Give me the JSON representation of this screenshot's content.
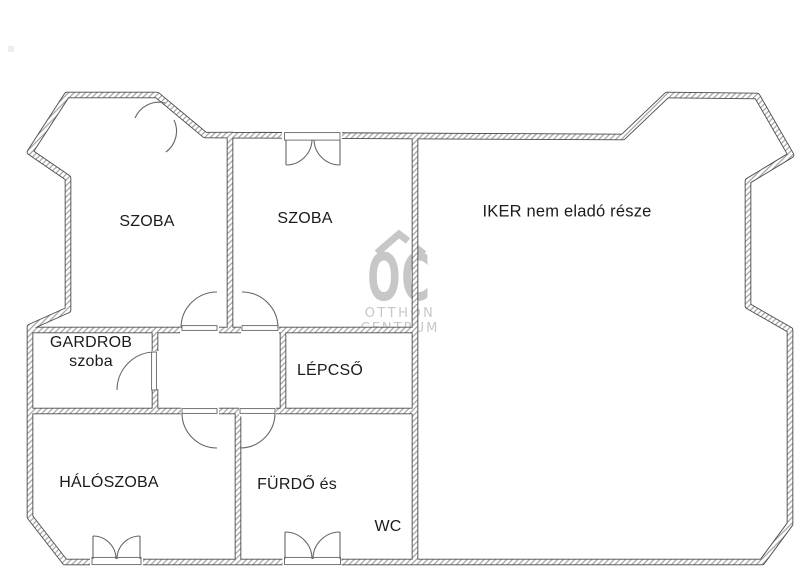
{
  "page": {
    "type": "apartment-floor-plan"
  },
  "rooms": {
    "szoba_left": "SZOBA",
    "szoba_middle": "SZOBA",
    "iker": "IKER nem eladó része",
    "gardrob_line1": "GARDROB",
    "gardrob_line2": "szoba",
    "lepcso": "LÉPCSŐ",
    "haloszoba": "HÁLÓSZOBA",
    "furdo": "FÜRDŐ és",
    "wc": "WC"
  },
  "watermark": {
    "logo_text": "OC",
    "line1": "OTTHON",
    "line2": "CENTRUM",
    "color": "#c7c7c7"
  },
  "colors": {
    "background": "#ffffff",
    "wall_line": "#4a4a4a",
    "wall_hatch": "#a0a0a0",
    "door_arc": "#666666",
    "label_text": "#1b1b1b"
  }
}
